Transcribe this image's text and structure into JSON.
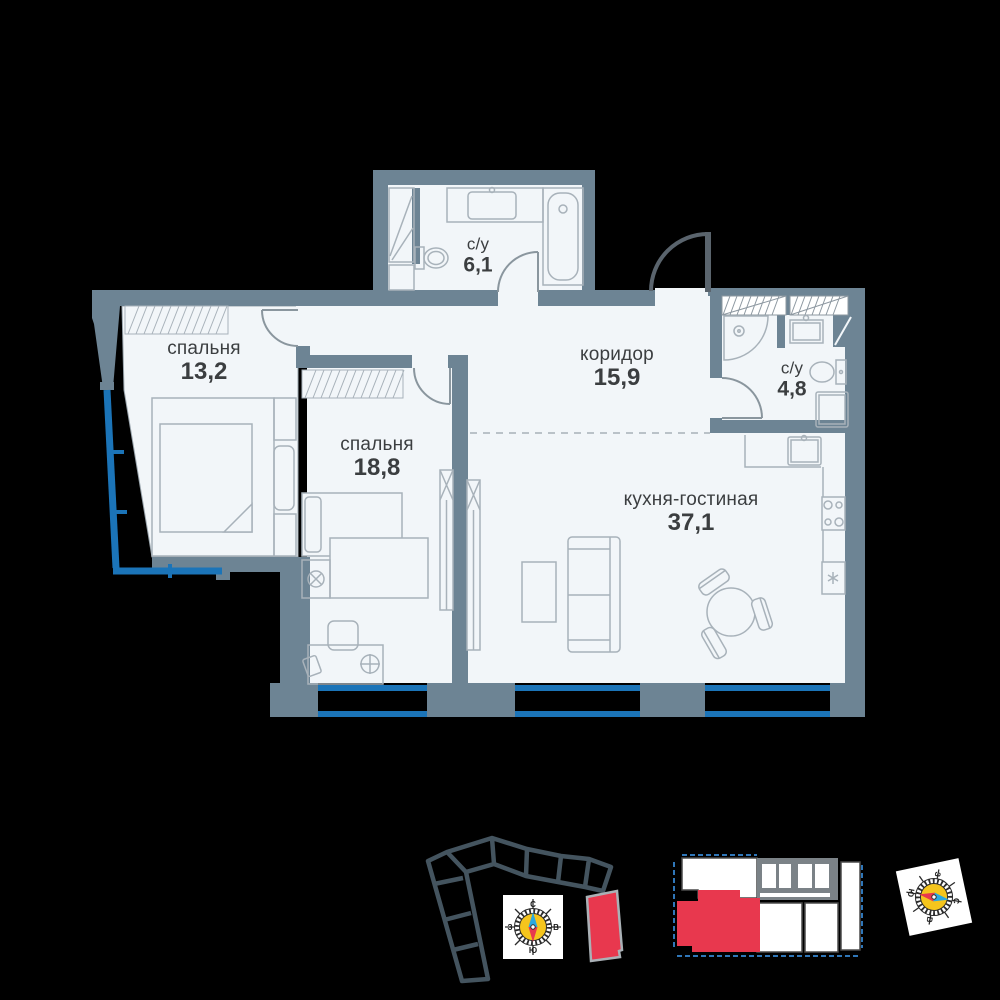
{
  "plan": {
    "rooms": [
      {
        "name": "спальня",
        "area": "13,2"
      },
      {
        "name": "спальня",
        "area": "18,8"
      },
      {
        "name": "с/у",
        "area": "6,1"
      },
      {
        "name": "коридор",
        "area": "15,9"
      },
      {
        "name": "с/у",
        "area": "4,8"
      },
      {
        "name": "кухня-гостиная",
        "area": "37,1"
      }
    ]
  },
  "compass": {
    "north": "С",
    "east": "В",
    "south": "Ю",
    "west": "З"
  },
  "colors": {
    "wall": "#6d8494",
    "floor": "#f2f6f9",
    "glazing_blue": "#1b74b8",
    "highlight_red": "#e8384e",
    "building_outline": "#44545f",
    "compass_face_yellow": "#f5c51d",
    "needle_north_blue": "#2ba8e0",
    "needle_south_red": "#e8384e"
  }
}
